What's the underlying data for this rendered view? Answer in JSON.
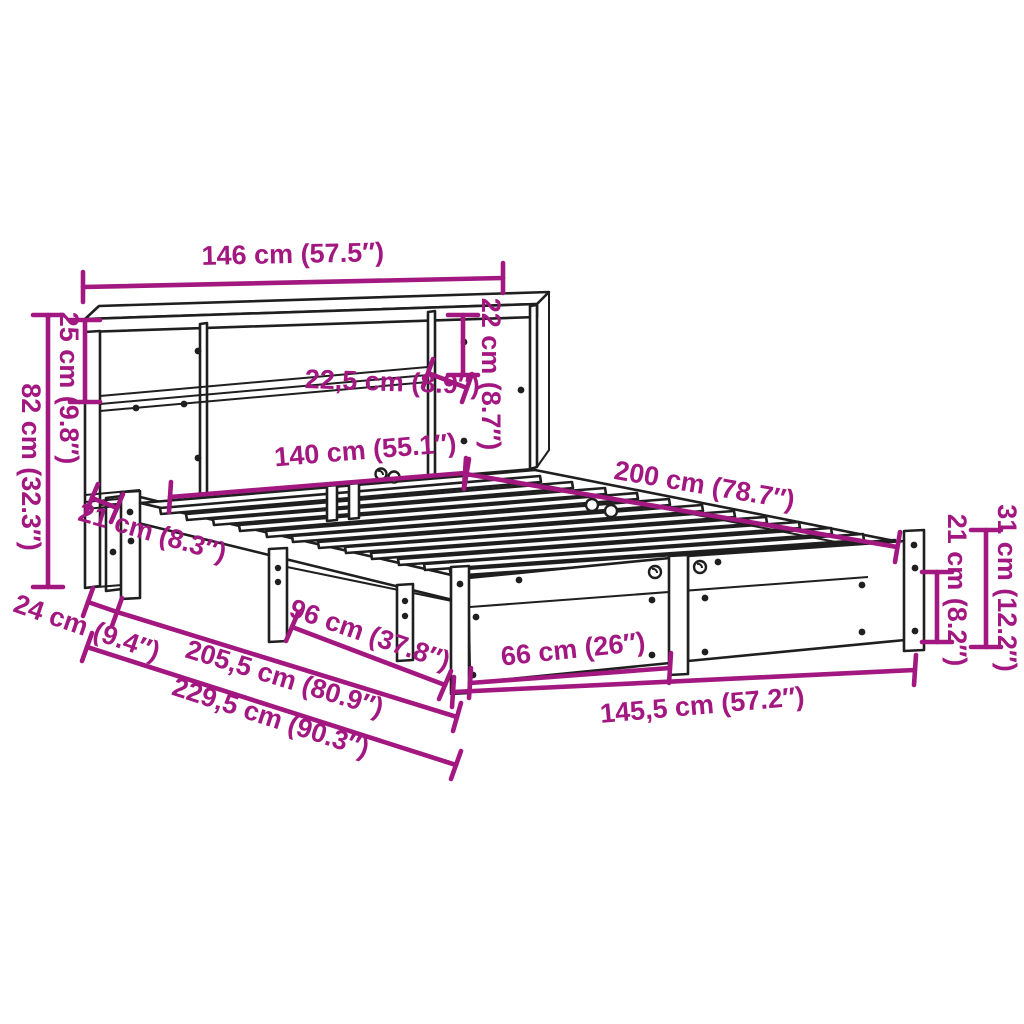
{
  "diagram": {
    "accent_color": "#A21780",
    "line_color": "#1F1F1F",
    "background_color": "#FFFFFF",
    "subject": "bookcase-bed-dimension-diagram",
    "dimensions": {
      "headboard_width": "146 cm (57.5″)",
      "top_shelf_height": "25 cm (9.8″)",
      "headboard_height": "82 cm (32.3″)",
      "compartment_height": "22 cm (8.7″)",
      "shelf_depth": "22,5 cm (8.9″)",
      "slat_width": "140 cm (55.1″)",
      "bed_length": "200 cm (78.7″)",
      "lower_shelf_depth": "21 cm (8.3″)",
      "headboard_depth": "24 cm (9.4″)",
      "frame_length": "205,5 cm (80.9″)",
      "total_length": "229,5 cm (90.3″)",
      "side_rail_length": "96 cm (37.8″)",
      "foot_panel_width": "66 cm (26″)",
      "frame_width": "145,5 cm (57.2″)",
      "rail_height": "21 cm (8.2″)",
      "leg_height": "31 cm (12.2″)"
    }
  }
}
